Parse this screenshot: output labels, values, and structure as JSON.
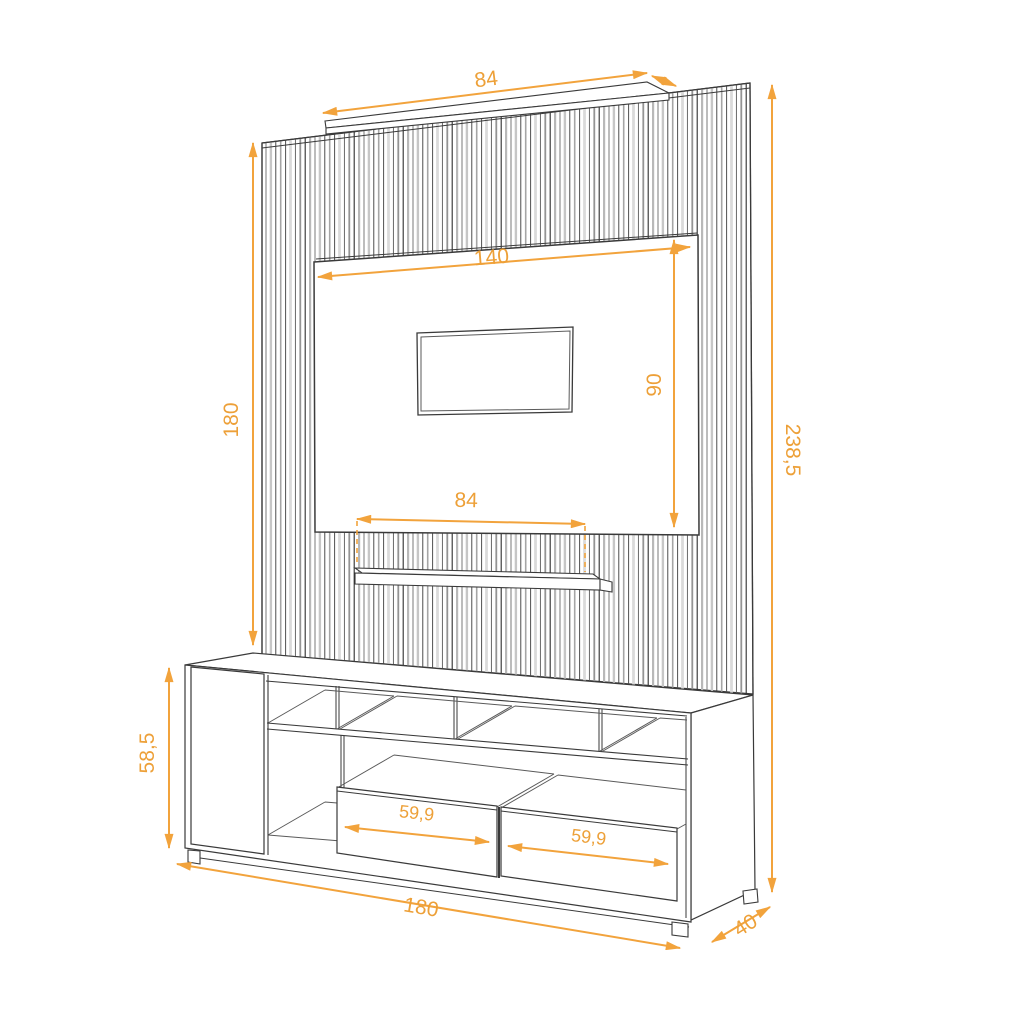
{
  "drawing": {
    "subject": "entertainment-center-technical-drawing",
    "accent_color": "#F2A33C",
    "line_color": "#3A3A3A",
    "dimensions": {
      "top_shelf_width": "84",
      "tv_panel_width": "140",
      "tv_panel_height": "90",
      "slat_panel_height": "180",
      "middle_shelf_width": "84",
      "total_height": "238,5",
      "cabinet_height": "58,5",
      "drawer_left_width": "59,9",
      "drawer_right_width": "59,9",
      "total_width": "180",
      "cabinet_depth": "40"
    }
  }
}
